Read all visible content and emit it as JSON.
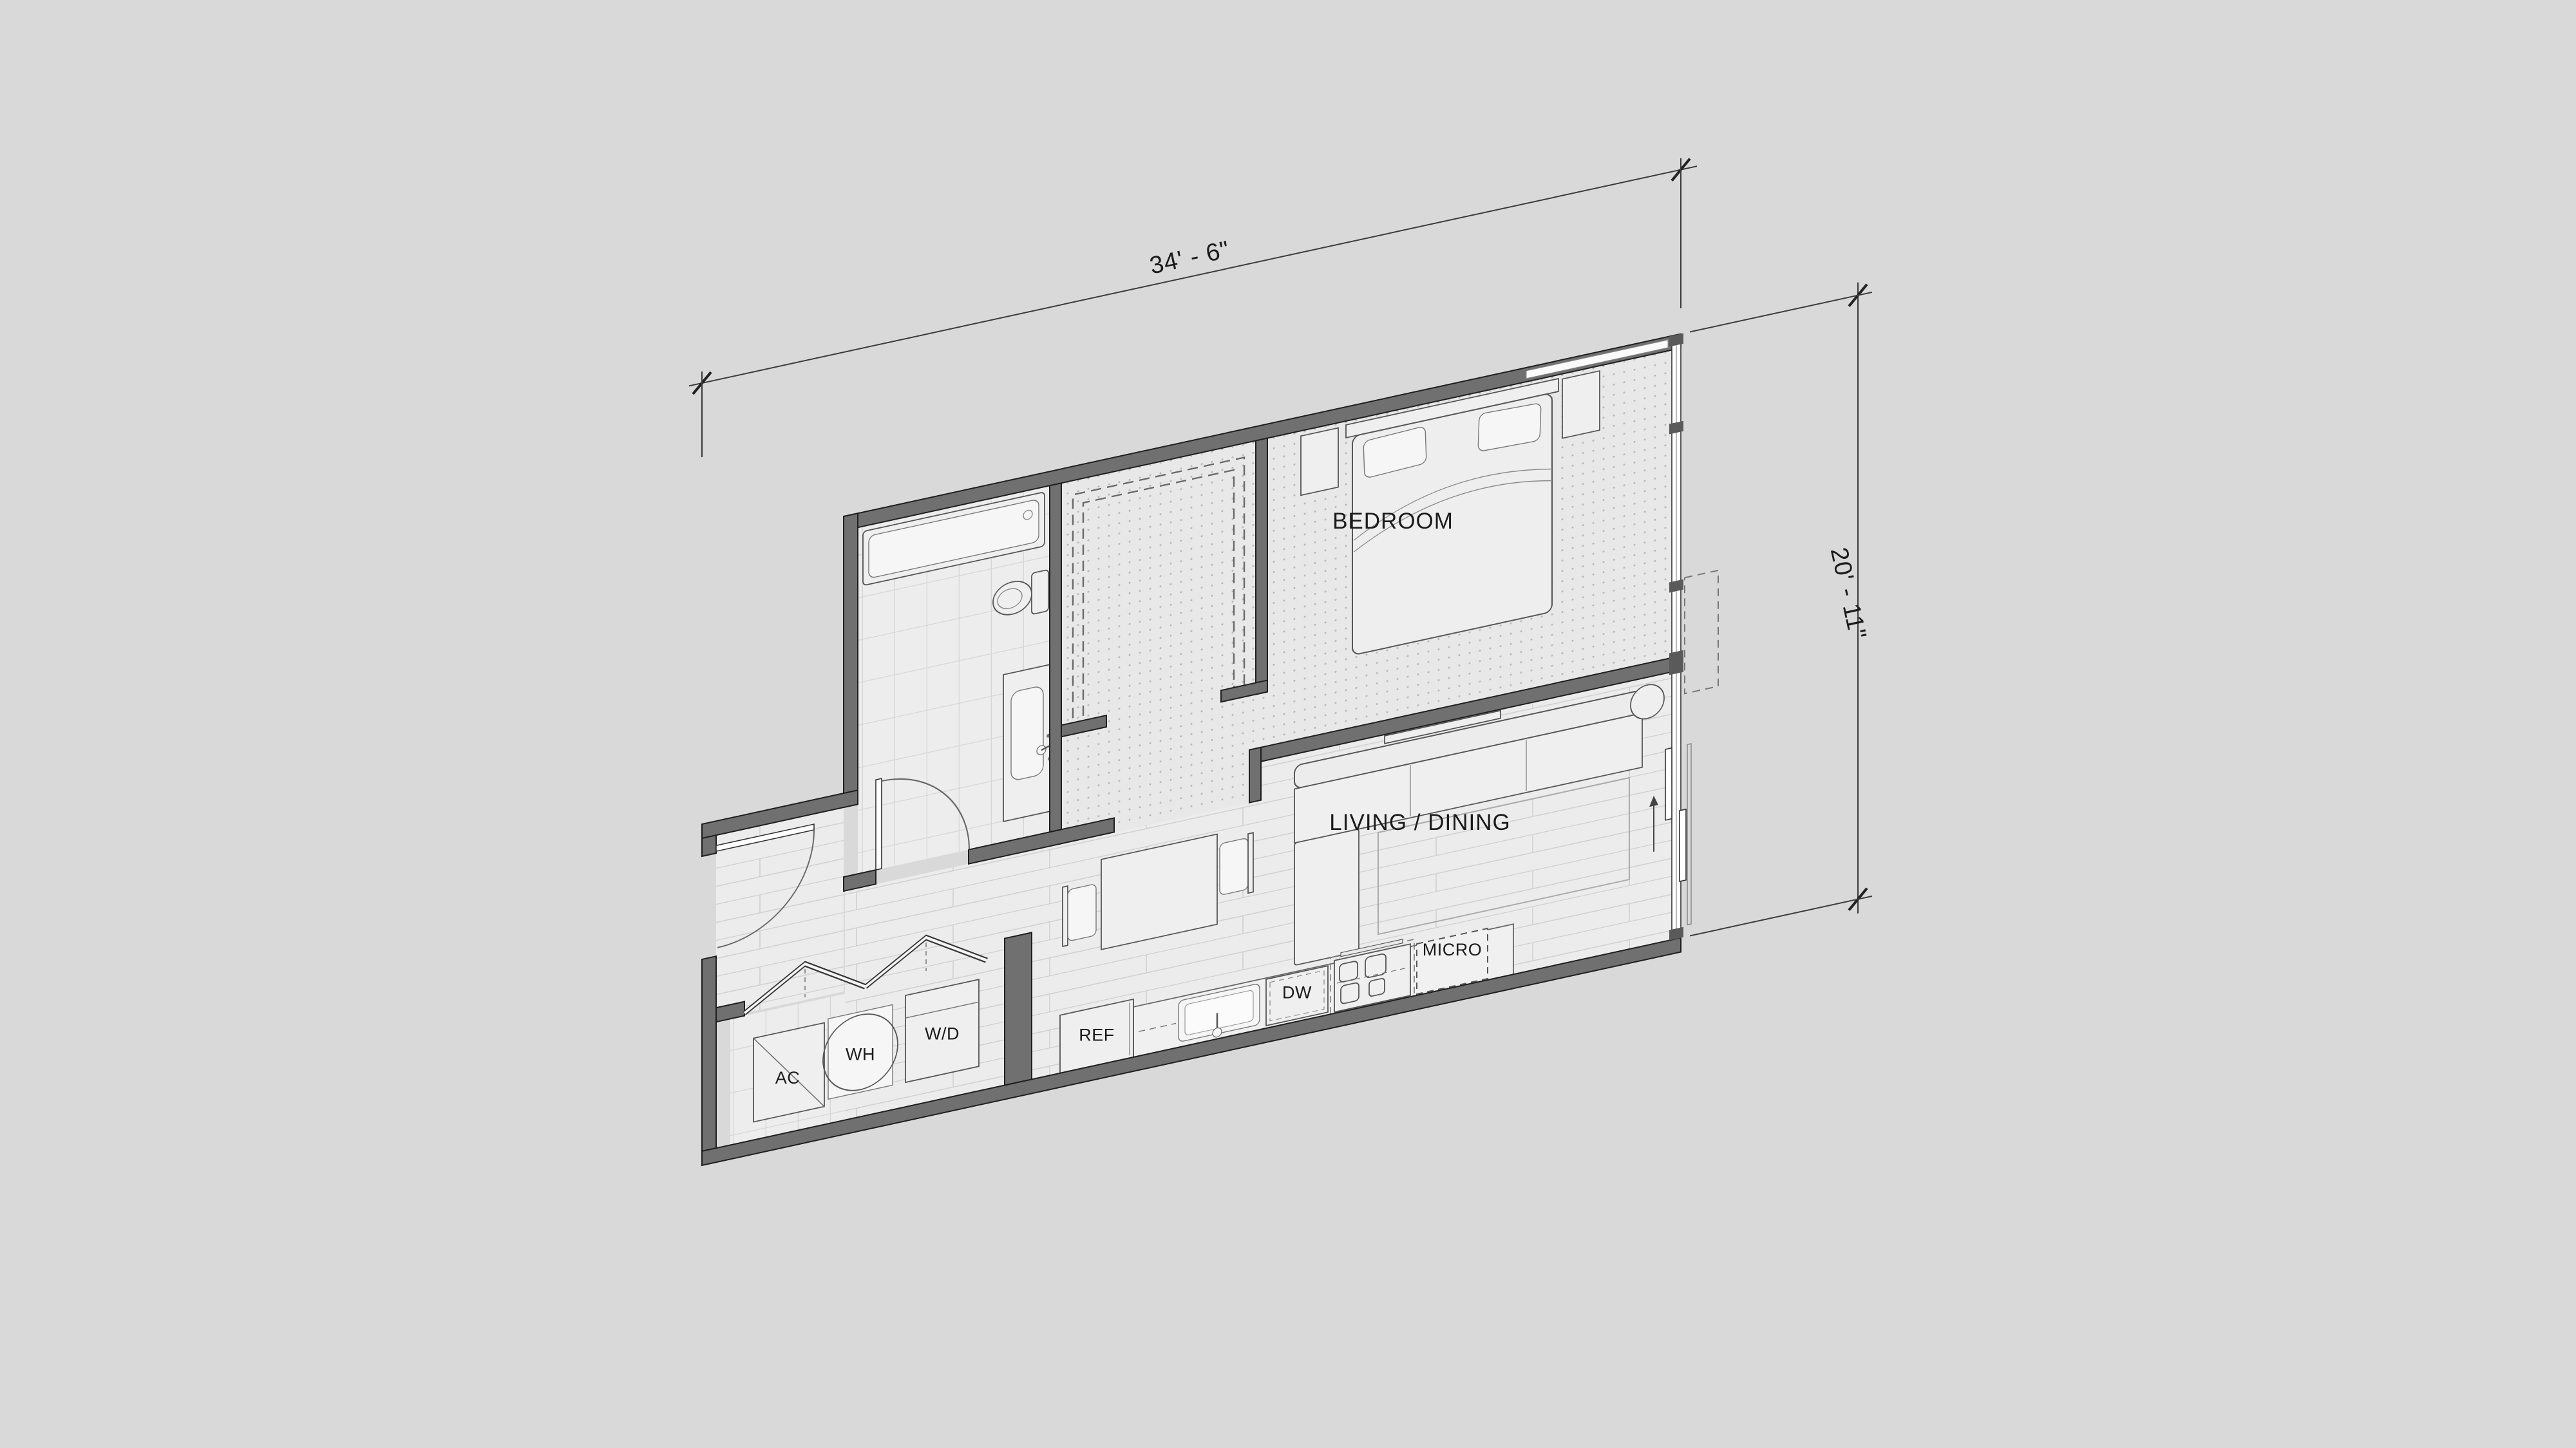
{
  "floor_plan": {
    "rooms": {
      "bedroom": "BEDROOM",
      "living_dining": "LIVING / DINING"
    },
    "appliances": {
      "ref": "REF",
      "dw": "DW",
      "micro": "MICRO",
      "ac": "AC",
      "wh": "WH",
      "wd": "W/D"
    },
    "dimensions": {
      "width": "34' - 6\"",
      "height": "20' - 11\""
    },
    "colors": {
      "background": "#d9d9d9",
      "wall_fill": "#707070",
      "wall_outline": "#1e1e1e",
      "floor_light": "#ececec",
      "carpet_dot": "#b8b8b8",
      "dimension_line": "#3a3a3a"
    }
  }
}
